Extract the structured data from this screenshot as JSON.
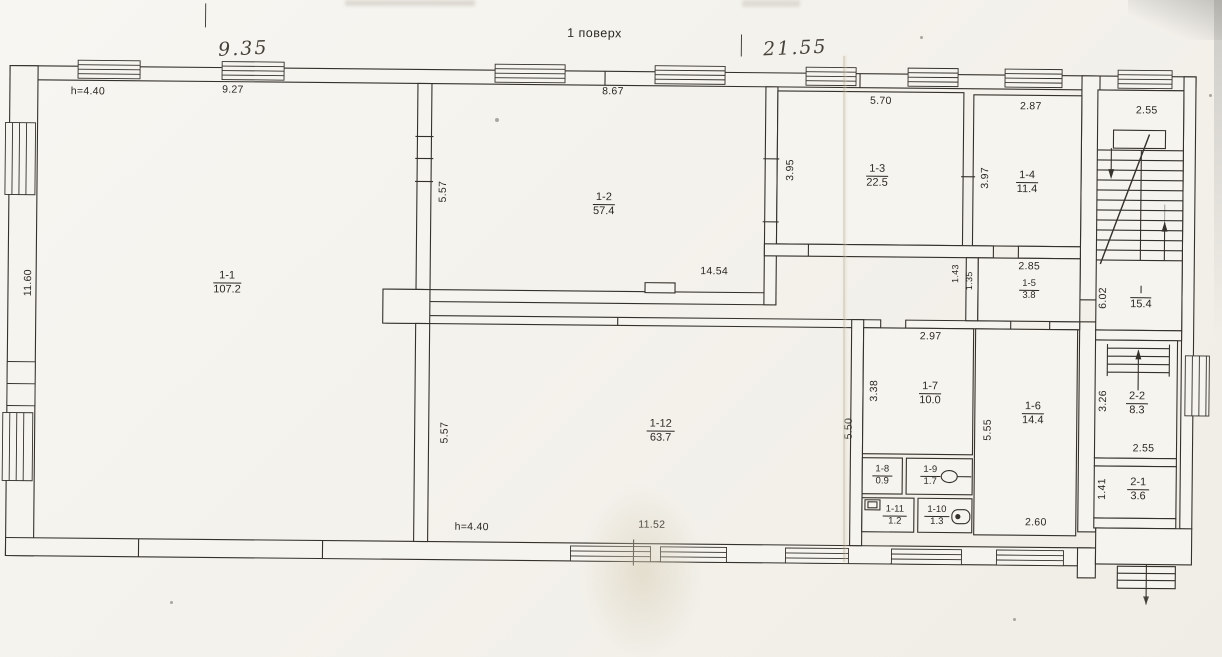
{
  "title": "1 поверх",
  "handwritten": {
    "left": "9.35",
    "right": "21.55"
  },
  "rooms": {
    "r1_1": {
      "num": "1-1",
      "area": "107.2"
    },
    "r1_2": {
      "num": "1-2",
      "area": "57.4"
    },
    "r1_3": {
      "num": "1-3",
      "area": "22.5"
    },
    "r1_4": {
      "num": "1-4",
      "area": "11.4"
    },
    "r1_5": {
      "num": "1-5",
      "area": "3.8"
    },
    "r1_6": {
      "num": "1-6",
      "area": "14.4"
    },
    "r1_7": {
      "num": "1-7",
      "area": "10.0"
    },
    "r1_8": {
      "num": "1-8",
      "area": "0.9"
    },
    "r1_9": {
      "num": "1-9",
      "area": "1.7"
    },
    "r1_10": {
      "num": "1-10",
      "area": "1.3"
    },
    "r1_11": {
      "num": "1-11",
      "area": "1.2"
    },
    "r1_12": {
      "num": "1-12",
      "area": "63.7"
    },
    "r2_1": {
      "num": "2-1",
      "area": "3.6"
    },
    "r2_2": {
      "num": "2-2",
      "area": "8.3"
    },
    "stairwell": {
      "num": "I",
      "area": "15.4"
    }
  },
  "dims": {
    "h_top": "h=4.40",
    "h_bottom": "h=4.40",
    "w9_27": "9.27",
    "w8_67": "8.67",
    "w5_70": "5.70",
    "w2_87": "2.87",
    "w2_55_top": "2.55",
    "w14_54": "14.54",
    "w2_85": "2.85",
    "w2_97": "2.97",
    "w2_60": "2.60",
    "w2_55_mid": "2.55",
    "w11_52": "11.52",
    "v11_60": "11.60",
    "v5_57_upper": "5.57",
    "v5_57_lower": "5.57",
    "v3_95": "3.95",
    "v3_97": "3.97",
    "v1_43": "1.43",
    "v1_35": "1.35",
    "v3_38": "3.38",
    "v5_50": "5.50",
    "v5_55": "5.55",
    "v6_02": "6.02",
    "v3_26": "3.26",
    "v1_41": "1.41"
  },
  "icons": {
    "toilet_1_9": "toilet-plan-icon",
    "toilet_1_10": "toilet-plan-icon",
    "sink_1_11": "sink-plan-icon",
    "stairs_up": "direction-arrow-up",
    "stairs_down": "direction-arrow-down"
  },
  "colors": {
    "ink": "#34312b",
    "paper": "#f6f4ef",
    "fold": "#d8cfbd"
  }
}
